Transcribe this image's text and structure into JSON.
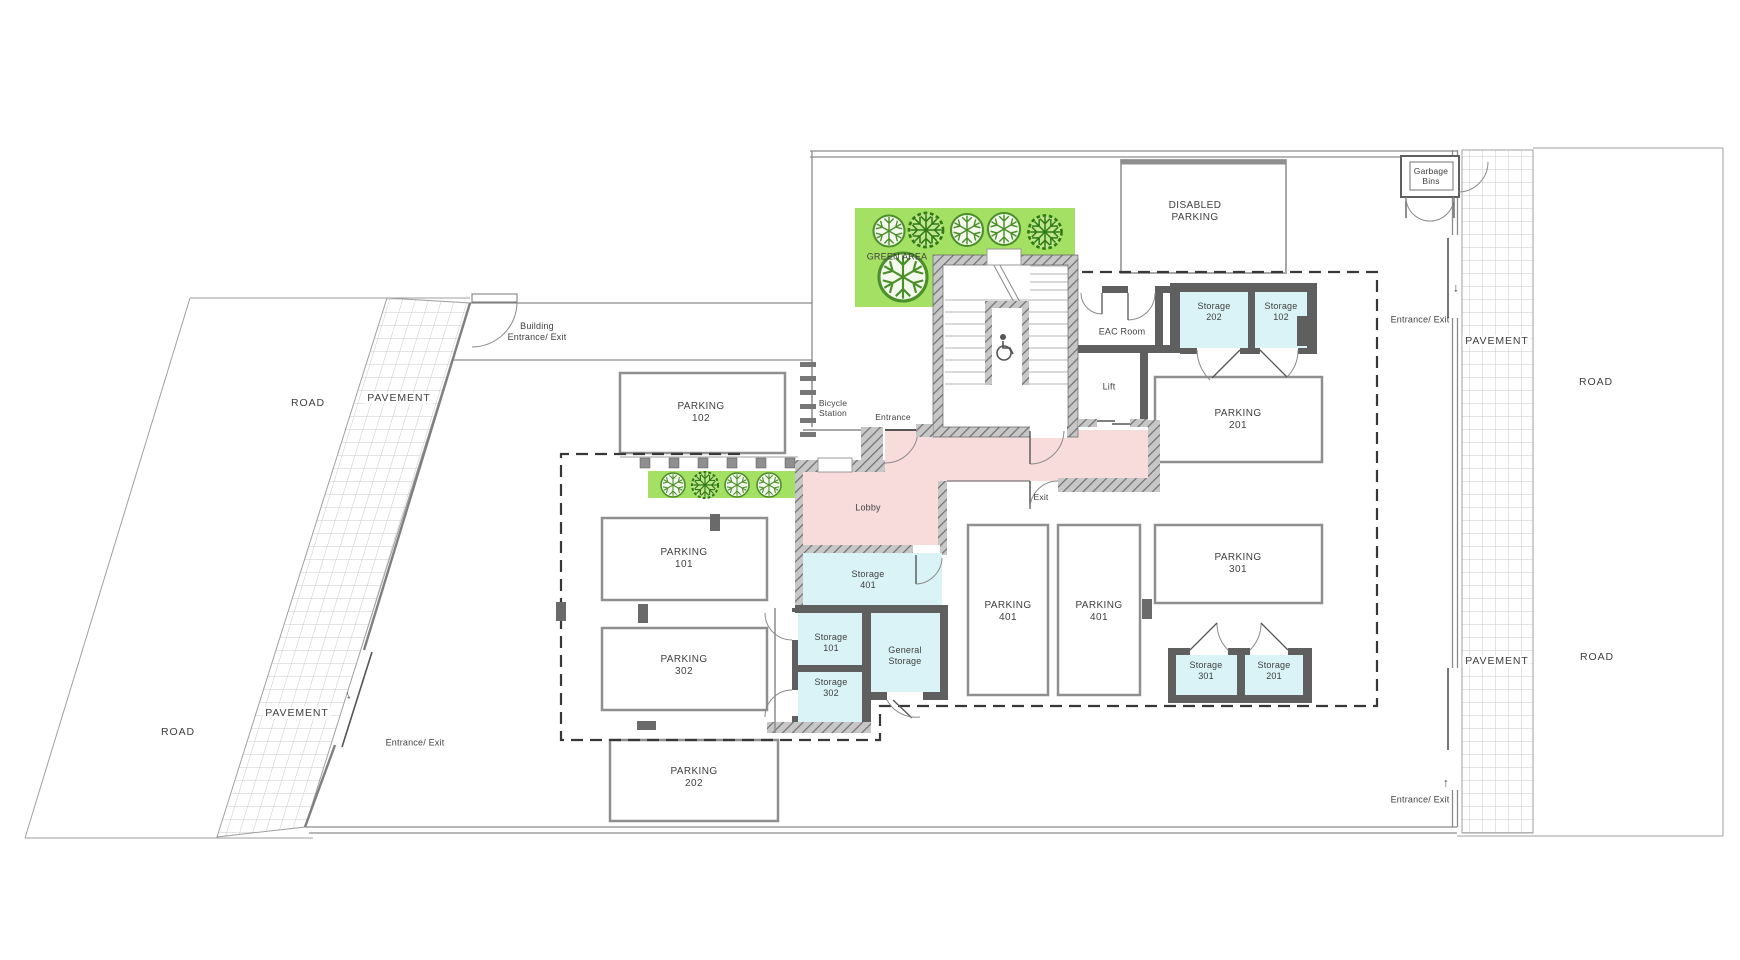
{
  "labels": {
    "road_left_top": "ROAD",
    "pavement_left_top": "PAVEMENT",
    "road_left_bottom": "ROAD",
    "pavement_left_bottom": "PAVEMENT",
    "entrance_exit_sw": "Entrance/ Exit",
    "building_entrance_exit": "Building\nEntrance/ Exit",
    "parking_102": "PARKING\n102",
    "bicycle_station": "Bicycle\nStation",
    "green_area": "GREEN AREA",
    "disabled_parking": "DISABLED\nPARKING",
    "garbage_bins": "Garbage\nBins",
    "entrance_exit_ne": "Entrance/ Exit",
    "arrow_ne": "↓",
    "pavement_right_top": "PAVEMENT",
    "road_right_top": "ROAD",
    "pavement_right_bottom": "PAVEMENT",
    "road_right_bottom": "ROAD",
    "entrance_exit_se": "Entrance/ Exit",
    "arrow_se": "↑",
    "arrow_sw": "↓",
    "storage_202": "Storage\n202",
    "storage_102": "Storage\n102",
    "eac_room": "EAC Room",
    "lift": "Lift",
    "parking_201": "PARKING\n201",
    "parking_301": "PARKING\n301",
    "storage_301": "Storage\n301",
    "storage_201": "Storage\n201",
    "parking_401_left": "PARKING\n401",
    "parking_401_right": "PARKING\n401",
    "entrance": "Entrance",
    "exit": "Exit",
    "lobby": "Lobby",
    "storage_401": "Storage\n401",
    "storage_101": "Storage\n101",
    "storage_302": "Storage\n302",
    "general_storage": "General\nStorage",
    "parking_101": "PARKING\n101",
    "parking_302": "PARKING\n302",
    "parking_202": "PARKING\n202"
  },
  "icons": {
    "wheelchair-icon": "♿",
    "arrow-down-icon": "↓",
    "arrow-up-icon": "↑",
    "tree-icon": "circular tree canopy symbol",
    "bicycle-rack-icon": "parallel bar rack symbol"
  },
  "colors": {
    "green": "#a4e063",
    "cyan": "#daf3f6",
    "pink": "#f8dcdc",
    "wall": "#5f5f5f",
    "line": "#8f8f8f",
    "dash": "#383838",
    "text": "#3f3f3f"
  }
}
